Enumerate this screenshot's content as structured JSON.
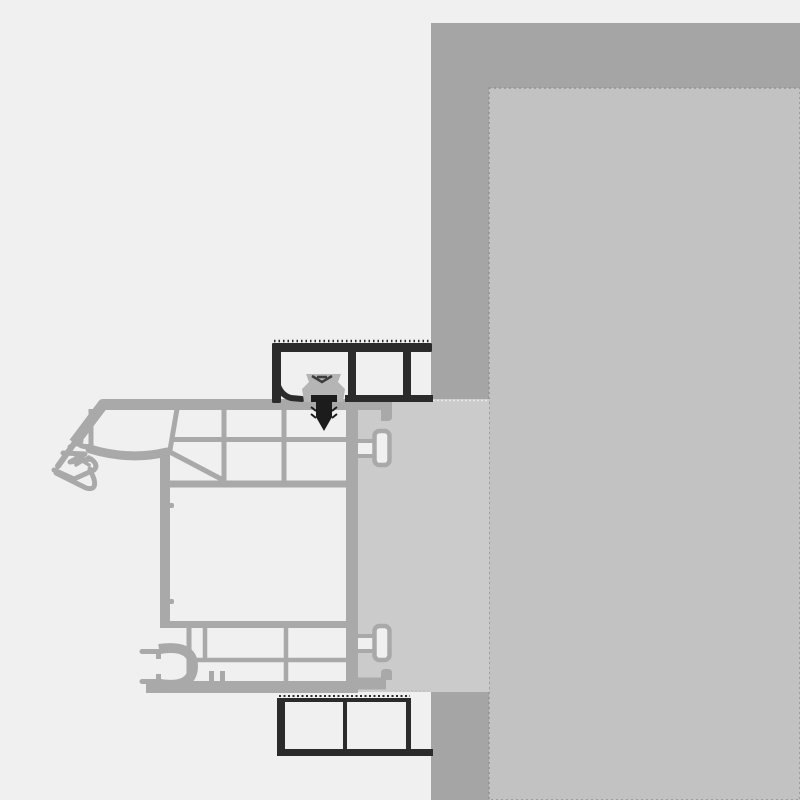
{
  "page": {
    "title": "Window frame to wall installation cross-section",
    "kind": "technical-drawing",
    "has_text": false
  },
  "colors": {
    "background": "#f0f0f0",
    "wall": "#a5a5a5",
    "wall_inner_panel": "#c2c2c2",
    "panel_edge_line": "#929292",
    "filler_strip": "#cbcbcb",
    "strip_edge_light": "#e8e8e8",
    "strip_edge_shadow": "#c2c2c2",
    "profile_gray": "#a9a9a9",
    "chamber_fill": "#f0f0f0",
    "steel_dark": "#2b2b2b",
    "screw_dark": "#1c1c1c",
    "clip_gray": "#b5b5b5",
    "clip_hatch": "#3d3d3d"
  },
  "components": [
    {
      "id": "wall",
      "label": "Masonry wall"
    },
    {
      "id": "wall-inner-panel",
      "label": "Interior wall reveal surface"
    },
    {
      "id": "filler-strip",
      "label": "Joint filler / insulation strip"
    },
    {
      "id": "window-frame-profile",
      "label": "Multi-chamber window frame profile"
    },
    {
      "id": "glazing-gasket",
      "label": "Exterior sealing gasket"
    },
    {
      "id": "hardware-groove",
      "label": "Hardware (euro) groove"
    },
    {
      "id": "mounting-lugs",
      "label": "Frame mounting lugs"
    },
    {
      "id": "top-steel-angle",
      "label": "Upper steel angle profile"
    },
    {
      "id": "bottom-steel-angle",
      "label": "Lower steel angle profile"
    },
    {
      "id": "anchor-clip",
      "label": "Anchor clip"
    },
    {
      "id": "fixing-screw",
      "label": "Fixing screw"
    }
  ]
}
